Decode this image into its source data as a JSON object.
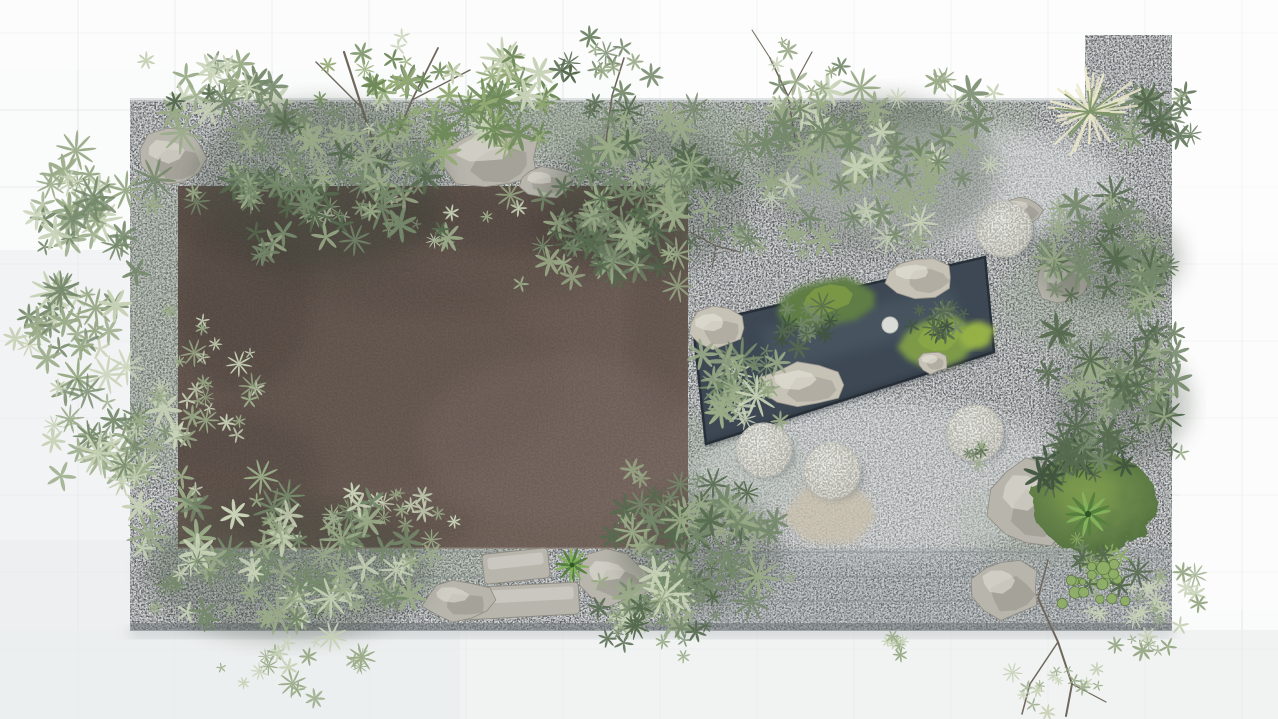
{
  "meta": {
    "label": "Top-down 3D rendering of a rectangular courtyard zen garden with a flat brown roof, gravel bed, dark reflecting pond, round stone discs and lush shrubs",
    "canvas": {
      "width": 1278,
      "height": 719
    }
  },
  "palette": {
    "bg": "#fafbfb",
    "bg_shade": "#eceff0",
    "bg_shade2": "#e8ebec",
    "tile_line": "#c9d0d2",
    "gravel": "#b4b9bb",
    "gravel_edge_top": "#cdd2d3",
    "gravel_green": "#8fa186",
    "gravel_wash": "#e3e6e6",
    "step_line": "#868d90",
    "platform_bottom": "#6e7578",
    "platform_shadow": "#999fa2",
    "drop_shadow": "#aab0b2",
    "roof": "#6e6058",
    "roof_dark": "#4a413b",
    "roof_light": "#80706a",
    "roof_edge": "#8d7f75",
    "pond": "#3d4854",
    "pond_dark": "#272f38",
    "pond_light": "#51606a",
    "moss": "#5f7d44",
    "moss_bright": "#7d9a4a",
    "moss_vivid": "#95b146",
    "moss_edge": "#4d6a3c",
    "rock": "#b7b5ac",
    "rock_dark": "#8e8c83",
    "rock_light": "#dcdad1",
    "prock": "#c6c2b6",
    "prock_dark": "#98948a",
    "prock_light": "#e3e0d7",
    "disc_hi": "#f0f0ea",
    "disc_lo": "#d9d9d0",
    "disc_rim": "#c6c6bd",
    "disc_shadow": "#555c60",
    "stepstone": "#dadcd7",
    "sand": "#c9c0ac",
    "leaf_pale": "#c7d2b6",
    "leaf_sage": "#9aab88",
    "leaf_mid": "#75896b",
    "leaf_deep": "#566b4f",
    "leaf_dark": "#41553f",
    "leaf_bright": "#8fae67",
    "canopy": "#93aa74",
    "canopy_deep": "#6f8a59",
    "branch": "#6f675c",
    "plume_cream": "#ece9cc",
    "plume_green": "#7e9468",
    "shadow_green": "#3d4a3b",
    "rosette_dark": "#55803e",
    "rosette_light": "#83b05a"
  },
  "background": {
    "grid_x0": 78,
    "tile_w": 97,
    "grid_y0": 33,
    "tile_h": 77,
    "shades": [
      {
        "x": 0,
        "y": 630,
        "w": 1278,
        "h": 89,
        "color": "#eceff0",
        "opacity": 0.7
      },
      {
        "x": 0,
        "y": 250,
        "w": 132,
        "h": 380,
        "color": "#eceff0",
        "opacity": 0.6
      },
      {
        "x": 0,
        "y": 540,
        "w": 460,
        "h": 179,
        "color": "#e8ebec",
        "opacity": 0.5
      },
      {
        "x": 640,
        "y": 0,
        "w": 638,
        "h": 250,
        "color": "#ffffff",
        "opacity": 0.5
      },
      {
        "x": 0,
        "y": 0,
        "w": 640,
        "h": 70,
        "color": "#ffffff",
        "opacity": 0.35
      },
      {
        "x": 1180,
        "y": 250,
        "w": 98,
        "h": 360,
        "color": "#ffffff",
        "opacity": 0.4
      }
    ]
  },
  "platform": {
    "x": 130,
    "y": 100,
    "w": 1042,
    "h": 530,
    "bump": {
      "x": 1085,
      "y": 35,
      "w": 87,
      "h": 65
    },
    "tints": [
      {
        "cx": 430,
        "cy": 135,
        "rx": 210,
        "ry": 38
      },
      {
        "cx": 820,
        "cy": 150,
        "rx": 170,
        "ry": 45
      },
      {
        "cx": 160,
        "cy": 330,
        "rx": 45,
        "ry": 150
      },
      {
        "cx": 700,
        "cy": 470,
        "rx": 110,
        "ry": 55
      },
      {
        "cx": 340,
        "cy": 555,
        "rx": 190,
        "ry": 45
      },
      {
        "cx": 1080,
        "cy": 300,
        "rx": 80,
        "ry": 55
      },
      {
        "cx": 1040,
        "cy": 520,
        "rx": 85,
        "ry": 45
      },
      {
        "cx": 620,
        "cy": 120,
        "rx": 120,
        "ry": 35
      },
      {
        "cx": 950,
        "cy": 120,
        "rx": 90,
        "ry": 30
      }
    ],
    "washes": [
      {
        "cx": 950,
        "cy": 185,
        "rx": 170,
        "ry": 60,
        "opacity": 0.5
      },
      {
        "cx": 880,
        "cy": 480,
        "rx": 190,
        "ry": 80,
        "opacity": 0.4
      }
    ],
    "steps_y": [
      552,
      577,
      601
    ],
    "shadow_band": {
      "x": 690,
      "y": 548,
      "w": 482,
      "h": 77,
      "opacity": 0.25
    }
  },
  "roof": {
    "x": 178,
    "y": 186,
    "w": 510,
    "h": 362,
    "shadows": [
      {
        "cx": 300,
        "cy": 218,
        "rx": 140,
        "ry": 46,
        "opacity": 0.35
      },
      {
        "cx": 520,
        "cy": 212,
        "rx": 130,
        "ry": 40,
        "opacity": 0.3
      },
      {
        "cx": 242,
        "cy": 300,
        "rx": 70,
        "ry": 92,
        "opacity": 0.3
      },
      {
        "cx": 430,
        "cy": 252,
        "rx": 185,
        "ry": 60,
        "opacity": 0.18
      },
      {
        "cx": 600,
        "cy": 232,
        "rx": 70,
        "ry": 34,
        "opacity": 0.3
      },
      {
        "cx": 664,
        "cy": 330,
        "rx": 36,
        "ry": 95,
        "opacity": 0.2
      },
      {
        "cx": 235,
        "cy": 470,
        "rx": 85,
        "ry": 60,
        "opacity": 0.25
      },
      {
        "cx": 352,
        "cy": 528,
        "rx": 120,
        "ry": 28,
        "opacity": 0.25
      },
      {
        "cx": 300,
        "cy": 380,
        "rx": 260,
        "ry": 120,
        "opacity": 0.12
      }
    ],
    "light": {
      "cx": 560,
      "cy": 440,
      "rx": 140,
      "ry": 85,
      "opacity": 0.35
    }
  },
  "pond": {
    "poly": [
      [
        693,
        325
      ],
      [
        985,
        257
      ],
      [
        994,
        352
      ],
      [
        706,
        444
      ]
    ],
    "streak": [
      [
        760,
        330
      ],
      [
        950,
        287
      ],
      [
        962,
        322
      ],
      [
        778,
        372
      ]
    ],
    "islands": [
      {
        "cx": 828,
        "cy": 303,
        "rx": 46,
        "ry": 25,
        "rot": -12,
        "color": "moss"
      },
      {
        "cx": 940,
        "cy": 340,
        "rx": 38,
        "ry": 26,
        "rot": -10,
        "color": "moss_bright"
      },
      {
        "cx": 976,
        "cy": 336,
        "rx": 18,
        "ry": 13,
        "rot": -20,
        "color": "moss_vivid"
      }
    ],
    "rocks": [
      {
        "cx": 920,
        "cy": 277,
        "rx": 33,
        "ry": 20
      },
      {
        "cx": 717,
        "cy": 328,
        "rx": 29,
        "ry": 21
      },
      {
        "cx": 803,
        "cy": 385,
        "rx": 40,
        "ry": 23
      },
      {
        "cx": 933,
        "cy": 362,
        "rx": 15,
        "ry": 11
      }
    ],
    "stepstone": {
      "cx": 890,
      "cy": 325,
      "r": 8
    }
  },
  "discs": [
    {
      "cx": 764,
      "cy": 450,
      "r": 27
    },
    {
      "cx": 832,
      "cy": 471,
      "r": 28
    },
    {
      "cx": 975,
      "cy": 433,
      "r": 28
    },
    {
      "cx": 1004,
      "cy": 229,
      "r": 28
    }
  ],
  "sand_patch": {
    "cx": 830,
    "cy": 516,
    "rx": 48,
    "ry": 30
  },
  "rocks": [
    {
      "name": "rock-topleft-edge",
      "cx": 172,
      "cy": 158,
      "rx": 34,
      "ry": 29
    },
    {
      "name": "rock-topcenter",
      "cx": 492,
      "cy": 158,
      "rx": 48,
      "ry": 30
    },
    {
      "name": "rock-topcenter-2",
      "cx": 545,
      "cy": 182,
      "rx": 26,
      "ry": 16
    },
    {
      "name": "boulder-bottomcenter",
      "cx": 612,
      "cy": 578,
      "rx": 36,
      "ry": 27
    },
    {
      "name": "rock-right",
      "cx": 1060,
      "cy": 280,
      "rx": 26,
      "ry": 23
    },
    {
      "name": "rock-under-disc4",
      "cx": 1022,
      "cy": 210,
      "rx": 20,
      "ry": 14
    },
    {
      "name": "rock-bottomright-large",
      "cx": 1032,
      "cy": 502,
      "rx": 42,
      "ry": 44
    },
    {
      "name": "rock-bottomright-slab",
      "cx": 1006,
      "cy": 588,
      "rx": 34,
      "ry": 30
    },
    {
      "name": "rock-bottomleft",
      "cx": 458,
      "cy": 600,
      "rx": 34,
      "ry": 20
    }
  ],
  "slabs": [
    {
      "name": "granite-slab-long",
      "cx": 520,
      "cy": 601,
      "w": 118,
      "h": 32,
      "rot": -3
    },
    {
      "name": "granite-slab-short",
      "cx": 516,
      "cy": 566,
      "w": 66,
      "h": 30,
      "rot": -6
    }
  ],
  "moss_mound": {
    "cx": 1095,
    "cy": 503,
    "rx": 62,
    "ry": 50
  },
  "branches": [
    {
      "name": "tall-tree-branches",
      "w": 2.2,
      "pts": [
        [
          390,
          238
        ],
        [
          382,
          170
        ],
        [
          362,
          108
        ],
        [
          344,
          52
        ]
      ]
    },
    {
      "name": "tall-tree-branch-2",
      "w": 1.8,
      "pts": [
        [
          382,
          170
        ],
        [
          412,
          100
        ],
        [
          438,
          48
        ]
      ]
    },
    {
      "name": "tall-tree-branch-3",
      "w": 1.4,
      "pts": [
        [
          362,
          108
        ],
        [
          316,
          62
        ]
      ]
    },
    {
      "name": "tall-tree-branch-4",
      "w": 1.4,
      "pts": [
        [
          412,
          100
        ],
        [
          470,
          70
        ]
      ]
    },
    {
      "name": "small-tree-branch",
      "w": 1.6,
      "pts": [
        [
          606,
          142
        ],
        [
          612,
          96
        ],
        [
          624,
          58
        ]
      ]
    },
    {
      "name": "sapling-branch",
      "w": 1.6,
      "pts": [
        [
          795,
          138
        ],
        [
          788,
          96
        ],
        [
          770,
          58
        ]
      ]
    },
    {
      "name": "sapling-branch-2",
      "w": 1.2,
      "pts": [
        [
          788,
          96
        ],
        [
          812,
          52
        ]
      ]
    },
    {
      "name": "sapling-branch-3",
      "w": 1.0,
      "pts": [
        [
          770,
          58
        ],
        [
          752,
          30
        ]
      ]
    },
    {
      "name": "roof-twig",
      "w": 1.2,
      "pts": [
        [
          690,
          232
        ],
        [
          716,
          246
        ],
        [
          740,
          252
        ]
      ]
    },
    {
      "name": "roof-twig-2",
      "w": 1.0,
      "pts": [
        [
          716,
          246
        ],
        [
          712,
          268
        ]
      ]
    },
    {
      "name": "corner-twig",
      "w": 2.0,
      "pts": [
        [
          1038,
          598
        ],
        [
          1058,
          642
        ],
        [
          1072,
          684
        ],
        [
          1066,
          716
        ]
      ]
    },
    {
      "name": "corner-twig-2",
      "w": 1.5,
      "pts": [
        [
          1058,
          642
        ],
        [
          1030,
          684
        ],
        [
          1022,
          714
        ]
      ]
    },
    {
      "name": "corner-twig-3",
      "w": 1.2,
      "pts": [
        [
          1072,
          684
        ],
        [
          1106,
          702
        ]
      ]
    },
    {
      "name": "corner-twig-4",
      "w": 1.5,
      "pts": [
        [
          1038,
          598
        ],
        [
          1048,
          560
        ]
      ]
    }
  ],
  "palettes": {
    "sage": [
      [
        "leaf_pale",
        3
      ],
      [
        "leaf_sage",
        4
      ],
      [
        "leaf_mid",
        3
      ]
    ],
    "mid": [
      [
        "leaf_sage",
        3
      ],
      [
        "leaf_mid",
        4
      ],
      [
        "leaf_deep",
        3
      ]
    ],
    "deep": [
      [
        "leaf_mid",
        3
      ],
      [
        "leaf_deep",
        4
      ],
      [
        "leaf_dark",
        3
      ]
    ],
    "yellow": [
      [
        "canopy",
        5
      ],
      [
        "canopy_deep",
        3
      ],
      [
        "leaf_pale",
        2
      ]
    ],
    "airy": [
      [
        "leaf_pale",
        5
      ],
      [
        "leaf_sage",
        5
      ]
    ],
    "bright": [
      [
        "leaf_bright",
        5
      ],
      [
        "leaf_mid",
        3
      ],
      [
        "leaf_deep",
        2
      ]
    ]
  },
  "clusters": [
    {
      "name": "roof-left-sprigs",
      "palette": "airy",
      "cx": 205,
      "cy": 370,
      "rx": 68,
      "ry": 95,
      "n": 26,
      "smin": 0.5,
      "smax": 1.0
    },
    {
      "name": "roof-bottom-sprigs",
      "palette": "airy",
      "cx": 400,
      "cy": 508,
      "rx": 100,
      "ry": 32,
      "n": 16,
      "smin": 0.5,
      "smax": 0.9
    },
    {
      "name": "roof-top-sprigs",
      "palette": "airy",
      "cx": 430,
      "cy": 220,
      "rx": 120,
      "ry": 40,
      "n": 14,
      "smin": 0.5,
      "smax": 0.9
    },
    {
      "name": "left-top-bamboo",
      "palette": "sage",
      "cx": 95,
      "cy": 205,
      "rx": 78,
      "ry": 58,
      "n": 36
    },
    {
      "name": "left-mid-bamboo",
      "palette": "sage",
      "cx": 75,
      "cy": 325,
      "rx": 72,
      "ry": 55,
      "n": 34
    },
    {
      "name": "left-low-bamboo",
      "palette": "sage",
      "cx": 118,
      "cy": 435,
      "rx": 82,
      "ry": 62,
      "n": 40
    },
    {
      "name": "top-left-tuft",
      "palette": "sage",
      "cx": 215,
      "cy": 95,
      "rx": 75,
      "ry": 48,
      "n": 26
    },
    {
      "name": "roof-canopy-left",
      "palette": "mid",
      "cx": 320,
      "cy": 170,
      "rx": 150,
      "ry": 108,
      "n": 88,
      "shadow": true
    },
    {
      "name": "tall-tree-foliage",
      "palette": "yellow",
      "cx": 392,
      "cy": 88,
      "rx": 88,
      "ry": 66,
      "n": 26,
      "smin": 0.6,
      "smax": 1.2
    },
    {
      "name": "yellowgreen-canopy",
      "palette": "yellow",
      "cx": 500,
      "cy": 105,
      "rx": 75,
      "ry": 55,
      "n": 38
    },
    {
      "name": "top-center-underbrush",
      "palette": "mid",
      "cx": 595,
      "cy": 245,
      "rx": 95,
      "ry": 55,
      "n": 36
    },
    {
      "name": "top-center-canopy",
      "palette": "mid",
      "cx": 648,
      "cy": 185,
      "rx": 118,
      "ry": 92,
      "n": 80,
      "shadow": true
    },
    {
      "name": "small-tree-foliage",
      "palette": "mid",
      "cx": 607,
      "cy": 72,
      "rx": 52,
      "ry": 42,
      "n": 16,
      "smin": 0.6,
      "smax": 1.1
    },
    {
      "name": "top-right-bamboo",
      "palette": "sage",
      "cx": 880,
      "cy": 158,
      "rx": 138,
      "ry": 98,
      "n": 88,
      "shadow": true
    },
    {
      "name": "sapling-foliage",
      "palette": "airy",
      "cx": 793,
      "cy": 84,
      "rx": 48,
      "ry": 50,
      "n": 10,
      "smin": 0.5,
      "smax": 0.9
    },
    {
      "name": "right-shrubs",
      "palette": "mid",
      "cx": 1108,
      "cy": 248,
      "rx": 88,
      "ry": 62,
      "n": 50,
      "shadow": true
    },
    {
      "name": "topright-corner-shrub",
      "palette": "mid",
      "cx": 1150,
      "cy": 120,
      "rx": 50,
      "ry": 42,
      "n": 20
    },
    {
      "name": "right-tree",
      "palette": "mid",
      "cx": 1122,
      "cy": 392,
      "rx": 82,
      "ry": 74,
      "n": 62,
      "shadow": true
    },
    {
      "name": "right-dark-bush",
      "palette": "deep",
      "cx": 1082,
      "cy": 455,
      "rx": 52,
      "ry": 34,
      "n": 30
    },
    {
      "name": "pond-edge-bush",
      "palette": "sage",
      "cx": 738,
      "cy": 388,
      "rx": 56,
      "ry": 46,
      "n": 36
    },
    {
      "name": "island-shrub",
      "palette": "deep",
      "cx": 808,
      "cy": 330,
      "rx": 36,
      "ry": 28,
      "n": 20,
      "smin": 0.5,
      "smax": 1.0
    },
    {
      "name": "island2-bush",
      "palette": "deep",
      "cx": 938,
      "cy": 327,
      "rx": 30,
      "ry": 22,
      "n": 15,
      "smin": 0.5,
      "smax": 1.0
    },
    {
      "name": "bottomleft-spill",
      "palette": "sage",
      "cx": 288,
      "cy": 558,
      "rx": 168,
      "ry": 88,
      "n": 92,
      "shadow": true
    },
    {
      "name": "bottomleft-scatter",
      "palette": "airy",
      "cx": 300,
      "cy": 658,
      "rx": 95,
      "ry": 42,
      "n": 20,
      "smin": 0.5,
      "smax": 1.0
    },
    {
      "name": "pondleft-bush",
      "palette": "mid",
      "cx": 700,
      "cy": 538,
      "rx": 96,
      "ry": 74,
      "n": 70,
      "shadow": true
    },
    {
      "name": "belowroof-bush",
      "palette": "sage",
      "cx": 648,
      "cy": 590,
      "rx": 66,
      "ry": 40,
      "n": 26
    },
    {
      "name": "bottomcenter-spill",
      "palette": "mid",
      "cx": 655,
      "cy": 628,
      "rx": 80,
      "ry": 38,
      "n": 24,
      "smin": 0.5,
      "smax": 1.1
    },
    {
      "name": "below-sprig",
      "palette": "airy",
      "cx": 895,
      "cy": 644,
      "rx": 28,
      "ry": 16,
      "n": 8,
      "smin": 0.4,
      "smax": 0.8
    },
    {
      "name": "disc-sprig",
      "palette": "mid",
      "cx": 982,
      "cy": 452,
      "rx": 18,
      "ry": 14,
      "n": 6,
      "smin": 0.4,
      "smax": 0.7
    },
    {
      "name": "corner-spill",
      "palette": "airy",
      "cx": 1152,
      "cy": 600,
      "rx": 75,
      "ry": 56,
      "n": 30,
      "smin": 0.5,
      "smax": 1.0
    },
    {
      "name": "corner-leafy",
      "palette": "bright",
      "cx": 1102,
      "cy": 560,
      "rx": 40,
      "ry": 34,
      "n": 22,
      "smin": 0.5,
      "smax": 1.1
    },
    {
      "name": "cornertwig-tufts",
      "palette": "airy",
      "cx": 1060,
      "cy": 688,
      "rx": 58,
      "ry": 30,
      "n": 16,
      "smin": 0.4,
      "smax": 0.8
    }
  ],
  "plume": {
    "cx": 1090,
    "cy": 112,
    "rays": 26,
    "len_min": 30,
    "len_max": 58,
    "green_rays": 16
  },
  "rosettes": [
    {
      "cx": 572,
      "cy": 565,
      "s": 0.8
    },
    {
      "cx": 1088,
      "cy": 514,
      "s": 1.05
    }
  ],
  "hosta": {
    "cx": 1098,
    "cy": 578,
    "n": 18,
    "rx": 40,
    "ry": 34
  }
}
